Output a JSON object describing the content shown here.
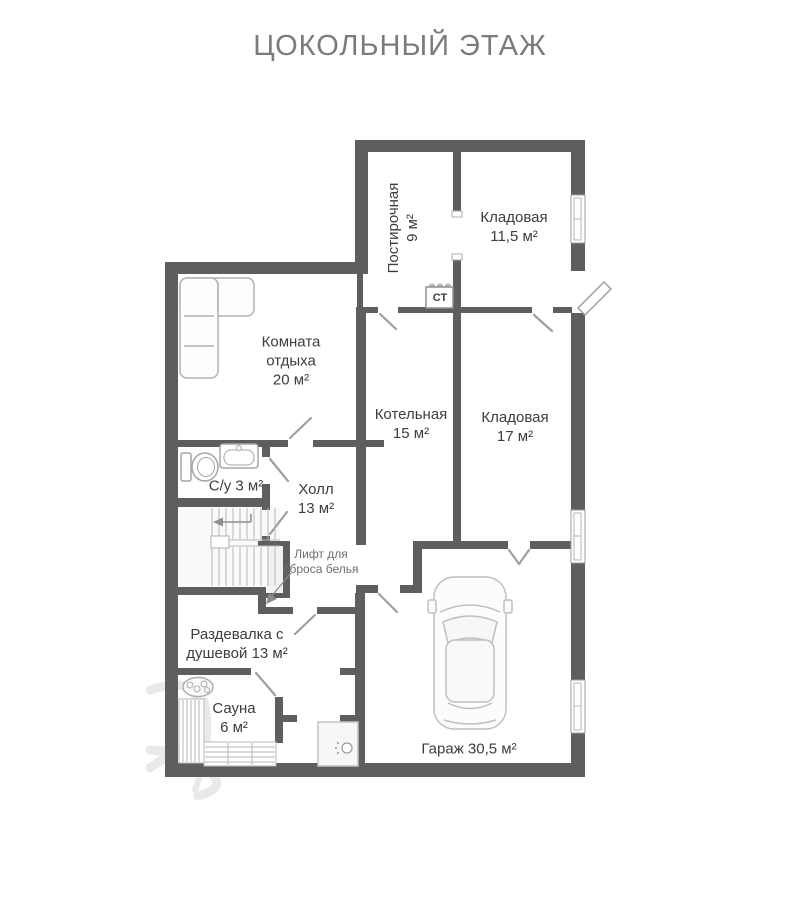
{
  "title": "ЦОКОЛЬНЫЙ ЭТАЖ",
  "floor_plan": {
    "rooms": [
      {
        "id": "postirochnaya",
        "name": "Постирочная",
        "area": "9 м²",
        "label_lines": [
          "Постирочная",
          "9 м²"
        ],
        "label_orientation": "vertical"
      },
      {
        "id": "kladovaya-11-5",
        "name": "Кладовая",
        "area": "11,5 м²",
        "label_lines": [
          "Кладовая",
          "11,5 м²"
        ]
      },
      {
        "id": "komnata-otdyha",
        "name": "Комната отдыха",
        "area": "20 м²",
        "label_lines": [
          "Комната",
          "отдыха",
          "20 м²"
        ]
      },
      {
        "id": "kotelnaya",
        "name": "Котельная",
        "area": "15 м²",
        "label_lines": [
          "Котельная",
          "15 м²"
        ]
      },
      {
        "id": "kladovaya-17",
        "name": "Кладовая",
        "area": "17 м²",
        "label_lines": [
          "Кладовая",
          "17 м²"
        ]
      },
      {
        "id": "sanuzel",
        "name": "С/у",
        "area": "3 м²",
        "label_lines": [
          "С/у 3 м²"
        ]
      },
      {
        "id": "holl",
        "name": "Холл",
        "area": "13 м²",
        "label_lines": [
          "Холл",
          "13 м²"
        ]
      },
      {
        "id": "razdevalka",
        "name": "Раздевалка с душевой",
        "area": "13 м²",
        "label_lines": [
          "Раздевалка с",
          "душевой 13 м²"
        ]
      },
      {
        "id": "sauna",
        "name": "Сауна",
        "area": "6 м²",
        "label_lines": [
          "Сауна",
          "6 м²"
        ]
      },
      {
        "id": "garage",
        "name": "Гараж",
        "area": "30,5 м²",
        "label_lines": [
          "Гараж 30,5 м²"
        ]
      }
    ],
    "annotations": [
      {
        "id": "laundry-chute",
        "label_lines": [
          "Лифт для",
          "сброса белья"
        ]
      },
      {
        "id": "ct-box",
        "label_lines": [
          "СТ"
        ]
      }
    ],
    "fixtures": [
      "sofa",
      "toilet",
      "sink",
      "stairs",
      "laundry-chute-shaft",
      "sauna-heater",
      "sauna-benches",
      "shower-cabin",
      "car"
    ],
    "colors": {
      "wall": "#5e5e5e",
      "label_text": "#3d3d3d",
      "muted_text": "#6e6e6e",
      "title_text": "#797b7f",
      "fixture_line": "#b7b7b7",
      "door_line": "#9f9f9f",
      "shaft_fill": "#f1f1f1"
    }
  }
}
